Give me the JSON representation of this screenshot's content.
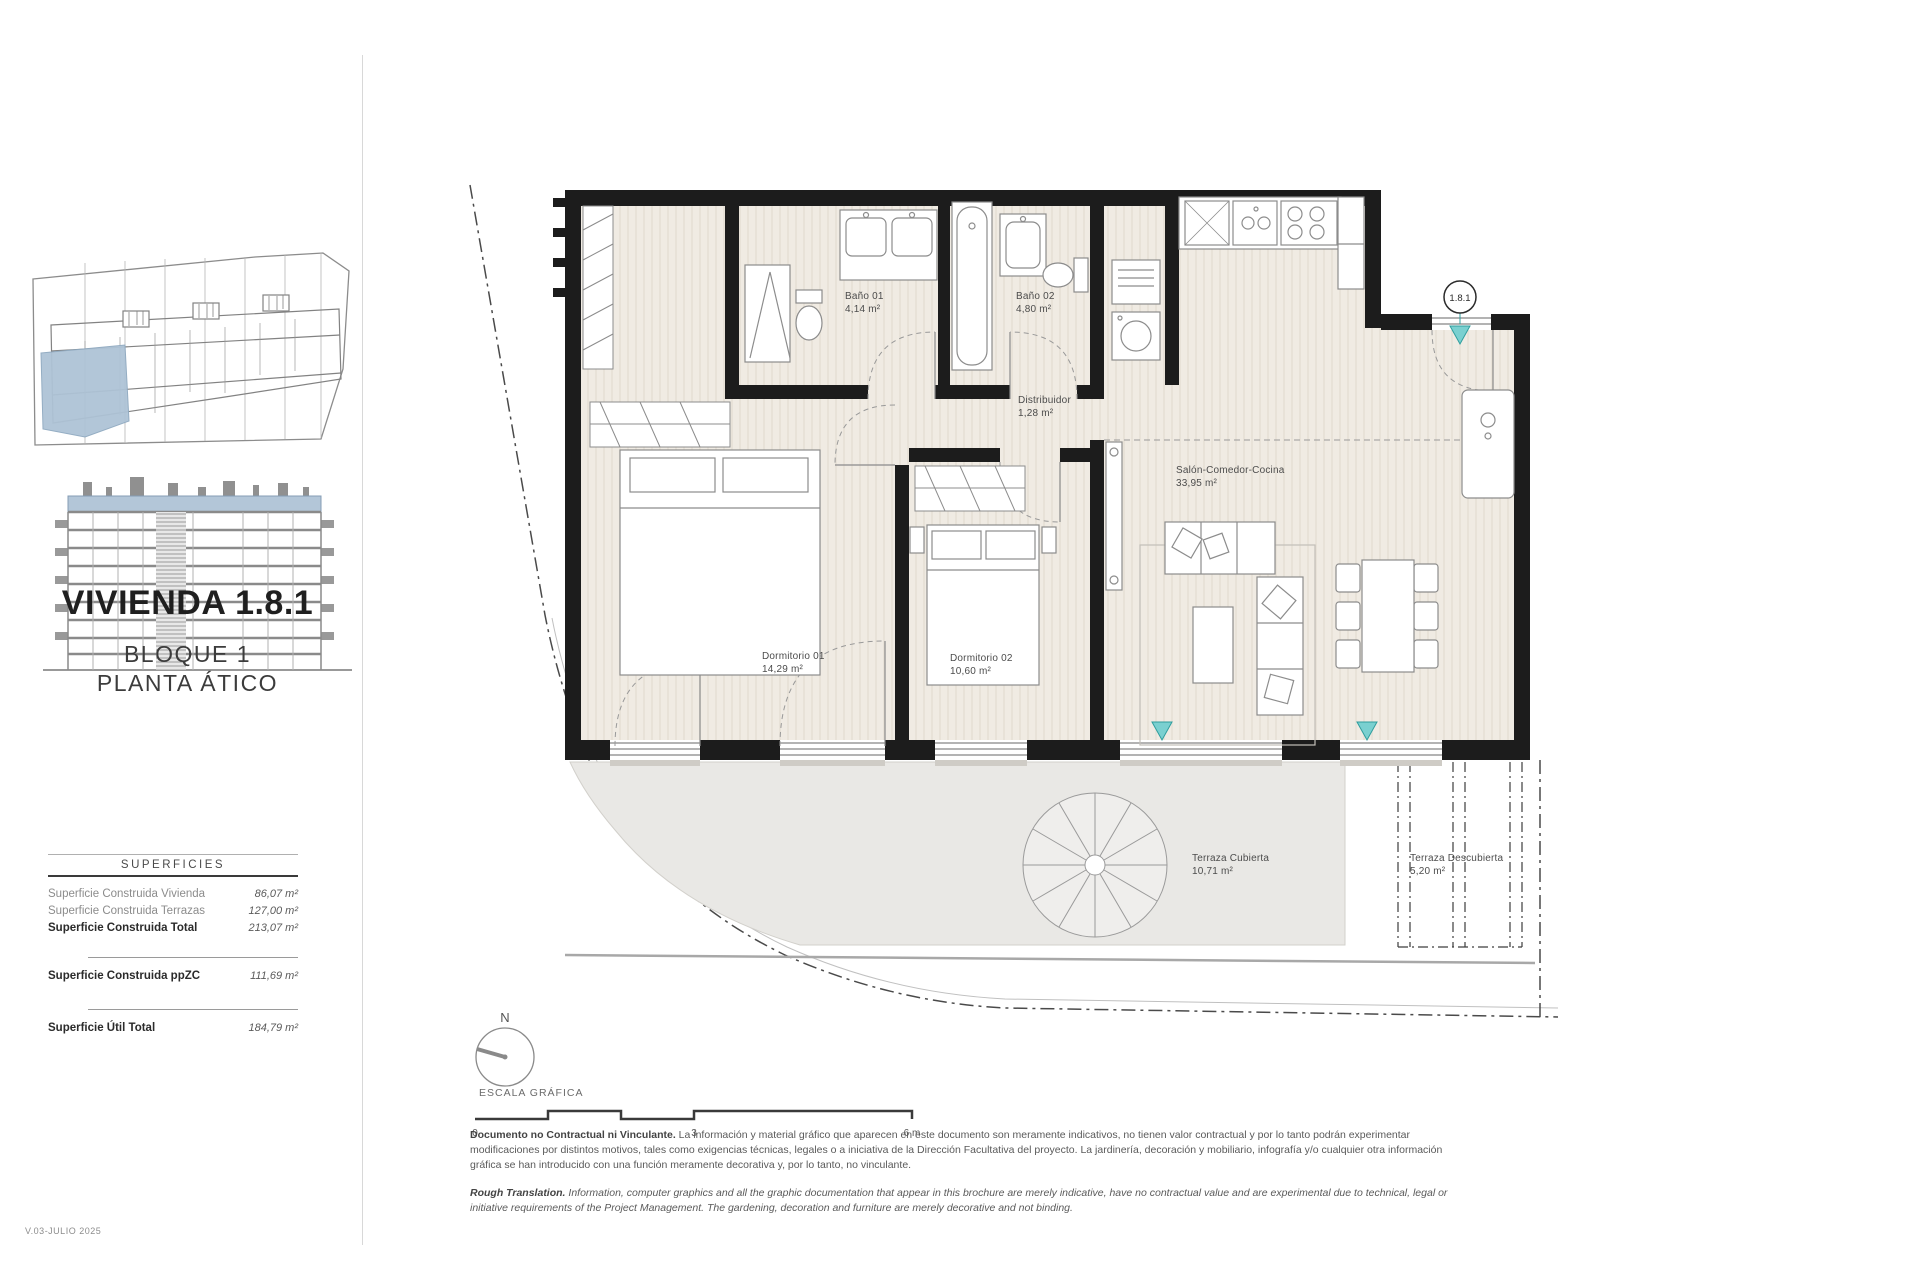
{
  "sidebar": {
    "title": "VIVIENDA 1.8.1",
    "block": "BLOQUE 1",
    "floor": "PLANTA ÁTICO",
    "surfaces_header": "SUPERFICIES",
    "rows": {
      "vivienda": {
        "label": "Superficie Construida Vivienda",
        "value": "86,07 m²"
      },
      "terrazas": {
        "label": "Superficie Construida Terrazas",
        "value": "127,00 m²"
      },
      "total": {
        "label": "Superficie Construida Total",
        "value": "213,07 m²"
      },
      "ppzc": {
        "label": "Superficie Construida ppZC",
        "value": "111,69 m²"
      },
      "util": {
        "label": "Superficie Útil Total",
        "value": "184,79 m²"
      }
    },
    "version": "V.03-JULIO 2025"
  },
  "plan": {
    "unit_badge": "1.8.1",
    "rooms": {
      "bano01": {
        "name": "Baño 01",
        "area": "4,14 m²"
      },
      "bano02": {
        "name": "Baño 02",
        "area": "4,80 m²"
      },
      "distribuidor": {
        "name": "Distribuidor",
        "area": "1,28 m²"
      },
      "salon": {
        "name": "Salón-Comedor-Cocina",
        "area": "33,95 m²"
      },
      "dorm01": {
        "name": "Dormitorio 01",
        "area": "14,29 m²"
      },
      "dorm02": {
        "name": "Dormitorio 02",
        "area": "10,60 m²"
      },
      "terraza_cubierta": {
        "name": "Terraza Cubierta",
        "area": "10,71 m²"
      },
      "terraza_descubierta": {
        "name": "Terraza Descubierta",
        "area": "5,20 m²"
      }
    }
  },
  "scale": {
    "north_label": "N",
    "label": "ESCALA GRÁFICA",
    "tick0": "0",
    "tick3": "3",
    "tick6": "6 m"
  },
  "disclaimer_es": {
    "lead": "Documento no Contractual ni Vinculante.",
    "text": " La información y material gráfico que aparecen en este documento son meramente indicativos, no tienen valor contractual y por lo tanto podrán experimentar modificaciones por distintos motivos, tales como exigencias técnicas, legales o a iniciativa de la Dirección Facultativa del proyecto. La jardinería, decoración y mobiliario, infografía y/o cualquier otra información gráfica se han introducido con una función meramente decorativa y, por lo tanto, no vinculante."
  },
  "disclaimer_en": {
    "lead": "Rough Translation.",
    "text": " Information, computer graphics and all the graphic documentation that appear in this brochure are merely indicative, have no contractual value and are experimental due to technical, legal or initiative requirements of the Project Management. The gardening, decoration and furniture are merely decorative and not binding."
  },
  "colors": {
    "wall": "#1c1c1c",
    "floor": "#f0ebe3",
    "terrace": "#e9e8e5",
    "highlight_blue": "#aec3d6",
    "accent_teal": "#7ad0d0",
    "accent_teal_border": "#2f9e9e"
  }
}
